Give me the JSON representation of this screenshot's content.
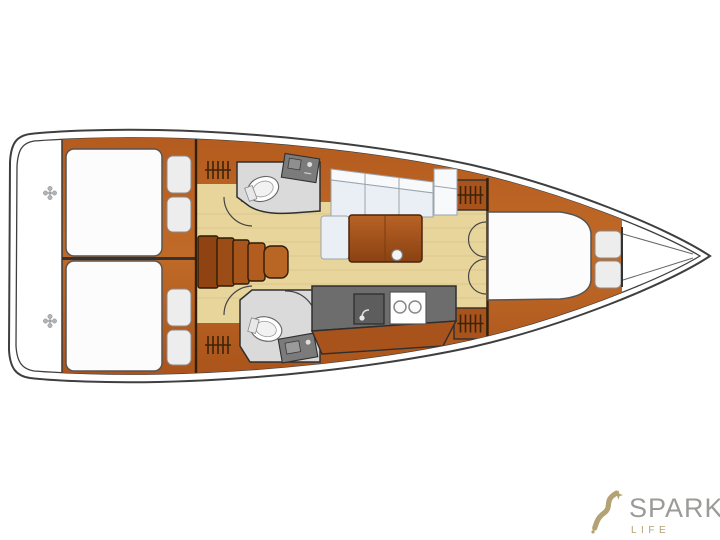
{
  "page": {
    "background": "#ffffff"
  },
  "logo": {
    "brand": "SPARKS",
    "subtitle": "LIFE",
    "icon": "sparkle-swoosh-icon"
  },
  "palette": {
    "page-bg": "#ffffff",
    "hull-line": "#3f3f3f",
    "wood": "#b2591f",
    "wood-cab": "#a8521c",
    "wood-dark": "#8f4313",
    "floor": "#e8d59c",
    "floor-line": "#d9c388",
    "counter": "#6d6d6d",
    "counter-dark": "#5d5d5d",
    "head-floor": "#dadada",
    "fixture-gray": "#7b7b7b",
    "mattress": "#fcfcfc",
    "cushion": "#ededed",
    "settee": "#e9eff4",
    "settee-light": "#f7f9fa",
    "outline-dark": "#2f2f2f",
    "brand": "#9b9b99",
    "accent": "#b3a273"
  },
  "plan": {
    "type": "sailing-yacht-interior-floor-plan",
    "orientation": "bow-right",
    "features": [
      "transom-platform",
      "aft-double-berth-top",
      "aft-double-berth-bottom",
      "wardrobe-lockers",
      "companionway-steps",
      "head-with-toilet-and-sink-top",
      "head-with-toilet-sink-and-shower-bottom",
      "salon-settee",
      "salon-table",
      "galley-with-sink-and-two-burner-stove",
      "forward-cabin-double-doors",
      "forward-v-berth",
      "bow-anchor-locker"
    ]
  }
}
